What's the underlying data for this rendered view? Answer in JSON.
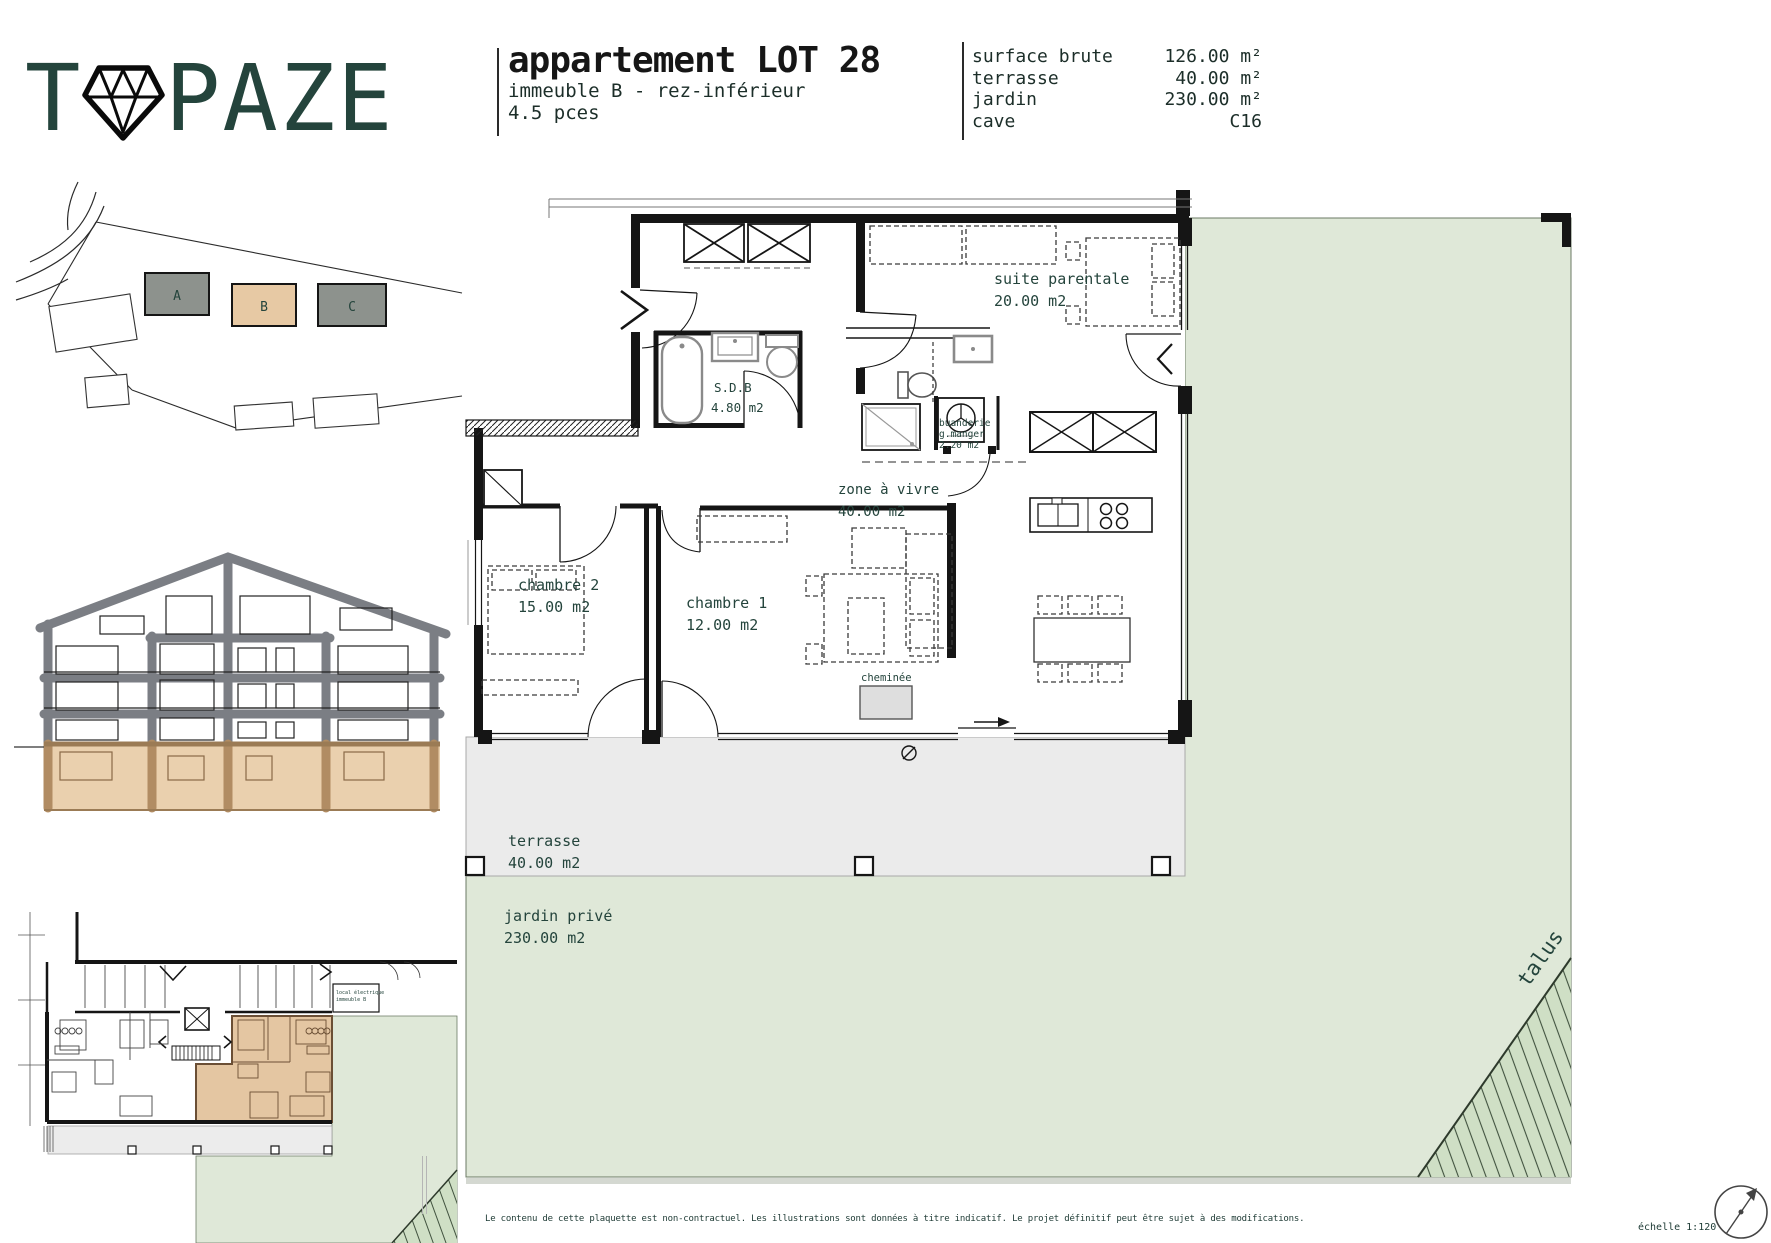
{
  "brand": {
    "name_prefix": "T",
    "name_suffix": "PAZE",
    "diamond_icon": "diamond"
  },
  "title_block": {
    "title": "appartement LOT 28",
    "subtitle": "immeuble B - rez-inférieur",
    "pieces": "4.5 pces"
  },
  "surface_table": {
    "rows": [
      {
        "label": "surface brute",
        "value": "126.00 m²"
      },
      {
        "label": "terrasse",
        "value": "40.00 m²"
      },
      {
        "label": "jardin",
        "value": "230.00 m²"
      },
      {
        "label": "cave",
        "value": "C16"
      }
    ]
  },
  "site_plan": {
    "buildings": [
      {
        "label": "A"
      },
      {
        "label": "B"
      },
      {
        "label": "C"
      }
    ],
    "highlighted_building": "B"
  },
  "floor_plan": {
    "suite": {
      "name": "suite parentale",
      "area": "20.00 m2"
    },
    "sdb": {
      "name": "S.D.B",
      "area": "4.80 m2"
    },
    "buanderie": {
      "line1": "buanderie",
      "line2": "g.manger",
      "line3": "2.20 m2"
    },
    "zone_a_vivre": {
      "name": "zone à vivre",
      "area": "40.00 m2"
    },
    "chambre2": {
      "name": "chambre 2",
      "area": "15.00 m2"
    },
    "chambre1": {
      "name": "chambre 1",
      "area": "12.00 m2"
    },
    "cheminee": {
      "name": "cheminée"
    },
    "terrasse": {
      "name": "terrasse",
      "area": "40.00 m2"
    },
    "jardin": {
      "name": "jardin privé",
      "area": "230.00 m2"
    },
    "talus": {
      "name": "talus"
    }
  },
  "overview_plan": {
    "local_room": {
      "line1": "local électrique",
      "line2": "immeuble B"
    }
  },
  "footer": {
    "disclaimer": "Le contenu de cette plaquette est non-contractuel. Les illustrations sont données à titre indicatif. Le projet définitif peut être sujet à des modifications.",
    "scale": "échelle 1:120"
  },
  "colors": {
    "accent_tan": "#e7c9a4",
    "garden_green": "#dfe8d8",
    "talus_green": "#cfdfc5",
    "terrace_grey": "#ebebeb",
    "cad_ink": "#24443c"
  }
}
